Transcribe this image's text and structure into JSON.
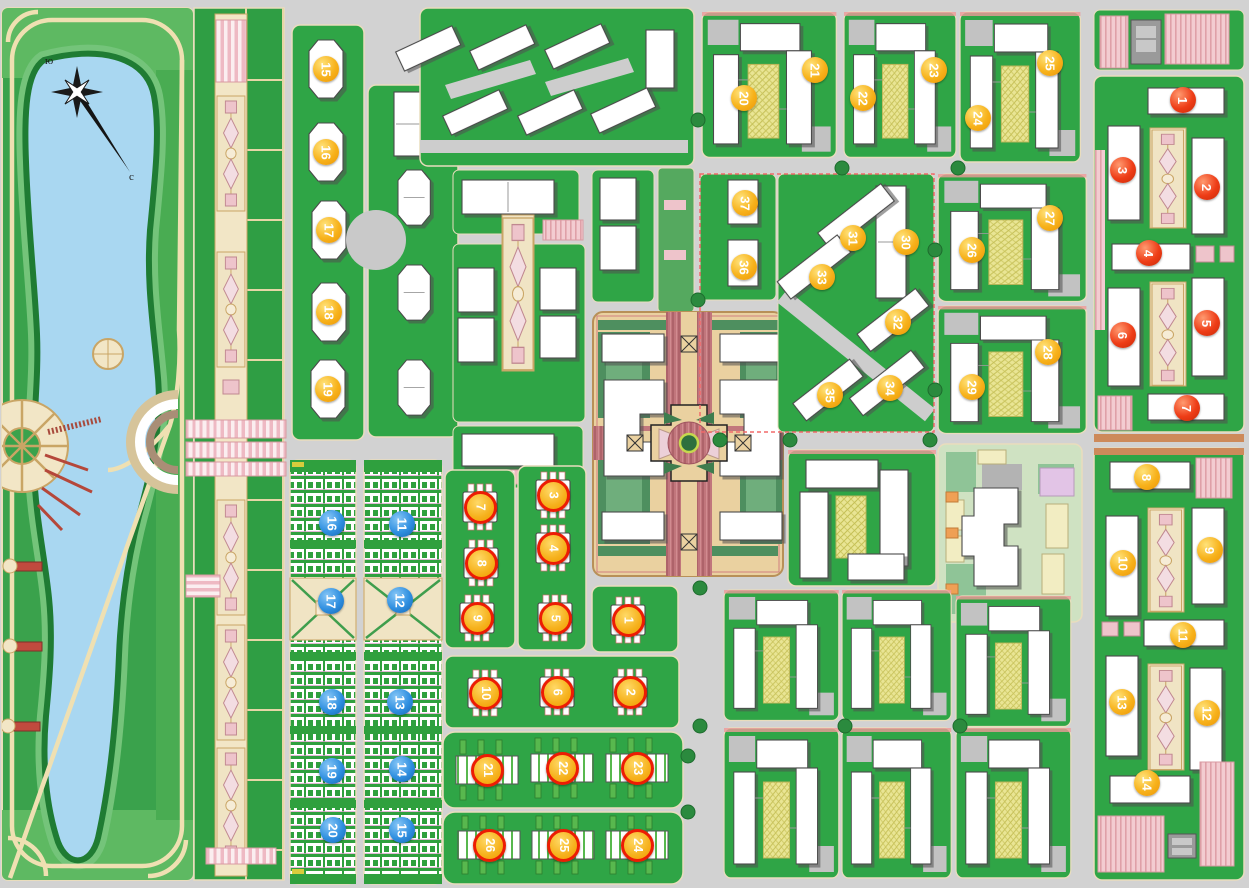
{
  "map": {
    "compass": {
      "south_label": "ю",
      "north_label": "с"
    },
    "colors": {
      "road_gray": "#d2d2d2",
      "lawn_green": "#2fa546",
      "park_green": "#3aa24c",
      "lake_blue": "#a9d7f1",
      "path_tan": "#f0e4c4",
      "ornament_rose": "#c2777c",
      "parking_pink": "#f3ccd1",
      "garden_yellow": "#e9e594",
      "building_white": "#ffffff",
      "marker_yellow": "#f7b21b",
      "marker_red": "#ee3d17",
      "marker_blue": "#2f8fe0",
      "marker_ring_red": "#ec1c04"
    },
    "markers": [
      {
        "n": "15",
        "t": "yellow",
        "x": 326,
        "y": 69
      },
      {
        "n": "16",
        "t": "yellow",
        "x": 326,
        "y": 152
      },
      {
        "n": "17",
        "t": "yellow",
        "x": 329,
        "y": 230
      },
      {
        "n": "18",
        "t": "yellow",
        "x": 329,
        "y": 312
      },
      {
        "n": "19",
        "t": "yellow",
        "x": 328,
        "y": 389
      },
      {
        "n": "20",
        "t": "yellow",
        "x": 744,
        "y": 98
      },
      {
        "n": "21",
        "t": "yellow",
        "x": 815,
        "y": 70
      },
      {
        "n": "22",
        "t": "yellow",
        "x": 863,
        "y": 98
      },
      {
        "n": "23",
        "t": "yellow",
        "x": 934,
        "y": 70
      },
      {
        "n": "24",
        "t": "yellow",
        "x": 978,
        "y": 118
      },
      {
        "n": "25",
        "t": "yellow",
        "x": 1050,
        "y": 63
      },
      {
        "n": "26",
        "t": "yellow",
        "x": 972,
        "y": 250
      },
      {
        "n": "27",
        "t": "yellow",
        "x": 1050,
        "y": 218
      },
      {
        "n": "28",
        "t": "yellow",
        "x": 1048,
        "y": 352
      },
      {
        "n": "29",
        "t": "yellow",
        "x": 972,
        "y": 387
      },
      {
        "n": "30",
        "t": "yellow",
        "x": 906,
        "y": 242
      },
      {
        "n": "31",
        "t": "yellow",
        "x": 853,
        "y": 238
      },
      {
        "n": "32",
        "t": "yellow",
        "x": 898,
        "y": 322
      },
      {
        "n": "33",
        "t": "yellow",
        "x": 822,
        "y": 277
      },
      {
        "n": "34",
        "t": "yellow",
        "x": 890,
        "y": 388
      },
      {
        "n": "35",
        "t": "yellow",
        "x": 830,
        "y": 395
      },
      {
        "n": "36",
        "t": "yellow",
        "x": 744,
        "y": 267
      },
      {
        "n": "37",
        "t": "yellow",
        "x": 745,
        "y": 203
      },
      {
        "n": "8",
        "t": "yellow",
        "x": 1147,
        "y": 477
      },
      {
        "n": "9",
        "t": "yellow",
        "x": 1210,
        "y": 550
      },
      {
        "n": "10",
        "t": "yellow",
        "x": 1123,
        "y": 563
      },
      {
        "n": "11",
        "t": "yellow",
        "x": 1183,
        "y": 635
      },
      {
        "n": "12",
        "t": "yellow",
        "x": 1207,
        "y": 713
      },
      {
        "n": "13",
        "t": "yellow",
        "x": 1122,
        "y": 702
      },
      {
        "n": "14",
        "t": "yellow",
        "x": 1147,
        "y": 783
      },
      {
        "n": "1",
        "t": "red",
        "x": 1183,
        "y": 100
      },
      {
        "n": "2",
        "t": "red",
        "x": 1207,
        "y": 187
      },
      {
        "n": "3",
        "t": "red",
        "x": 1123,
        "y": 170
      },
      {
        "n": "4",
        "t": "red",
        "x": 1149,
        "y": 253
      },
      {
        "n": "5",
        "t": "red",
        "x": 1207,
        "y": 323
      },
      {
        "n": "6",
        "t": "red",
        "x": 1123,
        "y": 335
      },
      {
        "n": "7",
        "t": "red",
        "x": 1187,
        "y": 408
      },
      {
        "n": "1",
        "t": "ringed",
        "x": 628,
        "y": 620
      },
      {
        "n": "2",
        "t": "ringed",
        "x": 630,
        "y": 692
      },
      {
        "n": "3",
        "t": "ringed",
        "x": 553,
        "y": 495
      },
      {
        "n": "4",
        "t": "ringed",
        "x": 553,
        "y": 548
      },
      {
        "n": "5",
        "t": "ringed",
        "x": 555,
        "y": 618
      },
      {
        "n": "6",
        "t": "ringed",
        "x": 557,
        "y": 692
      },
      {
        "n": "7",
        "t": "ringed",
        "x": 480,
        "y": 507
      },
      {
        "n": "8",
        "t": "ringed",
        "x": 481,
        "y": 563
      },
      {
        "n": "9",
        "t": "ringed",
        "x": 477,
        "y": 618
      },
      {
        "n": "10",
        "t": "ringed",
        "x": 485,
        "y": 693
      },
      {
        "n": "21",
        "t": "ringed",
        "x": 487,
        "y": 770
      },
      {
        "n": "22",
        "t": "ringed",
        "x": 562,
        "y": 768
      },
      {
        "n": "23",
        "t": "ringed",
        "x": 637,
        "y": 768
      },
      {
        "n": "24",
        "t": "ringed",
        "x": 637,
        "y": 845
      },
      {
        "n": "25",
        "t": "ringed",
        "x": 563,
        "y": 845
      },
      {
        "n": "26",
        "t": "ringed",
        "x": 489,
        "y": 845
      },
      {
        "n": "11",
        "t": "blue",
        "x": 402,
        "y": 524
      },
      {
        "n": "12",
        "t": "blue",
        "x": 400,
        "y": 600
      },
      {
        "n": "13",
        "t": "blue",
        "x": 400,
        "y": 702
      },
      {
        "n": "14",
        "t": "blue",
        "x": 402,
        "y": 769
      },
      {
        "n": "15",
        "t": "blue",
        "x": 402,
        "y": 830
      },
      {
        "n": "16",
        "t": "blue",
        "x": 332,
        "y": 523
      },
      {
        "n": "17",
        "t": "blue",
        "x": 331,
        "y": 601
      },
      {
        "n": "18",
        "t": "blue",
        "x": 332,
        "y": 702
      },
      {
        "n": "19",
        "t": "blue",
        "x": 332,
        "y": 771
      },
      {
        "n": "20",
        "t": "blue",
        "x": 333,
        "y": 830
      }
    ]
  }
}
